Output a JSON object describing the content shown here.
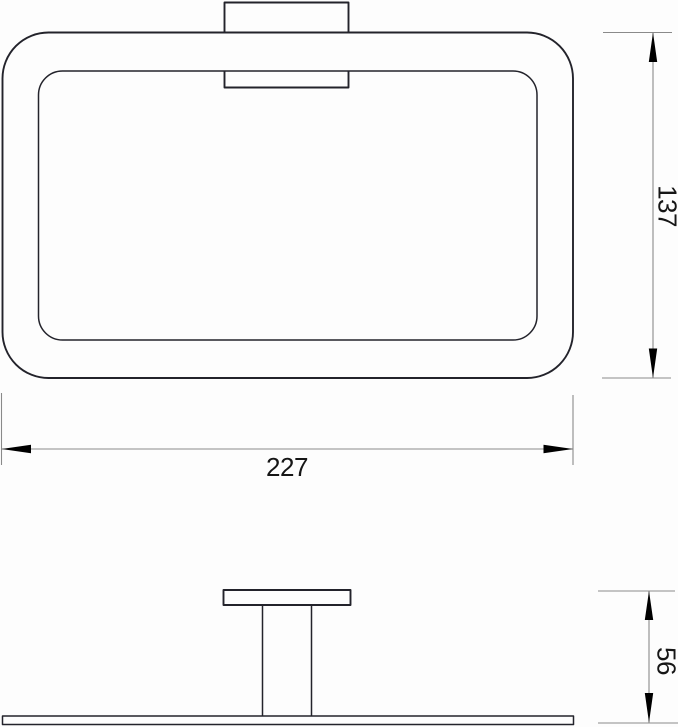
{
  "drawing": {
    "description": "Technical dimension drawing of a rectangular towel ring: front view with wall-mount bracket, side profile view below",
    "colors": {
      "background": "#fdfdfd",
      "outline": "#23232b",
      "dimension_line": "#8a8a8a",
      "arrow": "#000000",
      "text": "#161616"
    },
    "dimensions": {
      "width": {
        "label": "227"
      },
      "height": {
        "label": "137"
      },
      "depth": {
        "label": "56"
      }
    }
  }
}
